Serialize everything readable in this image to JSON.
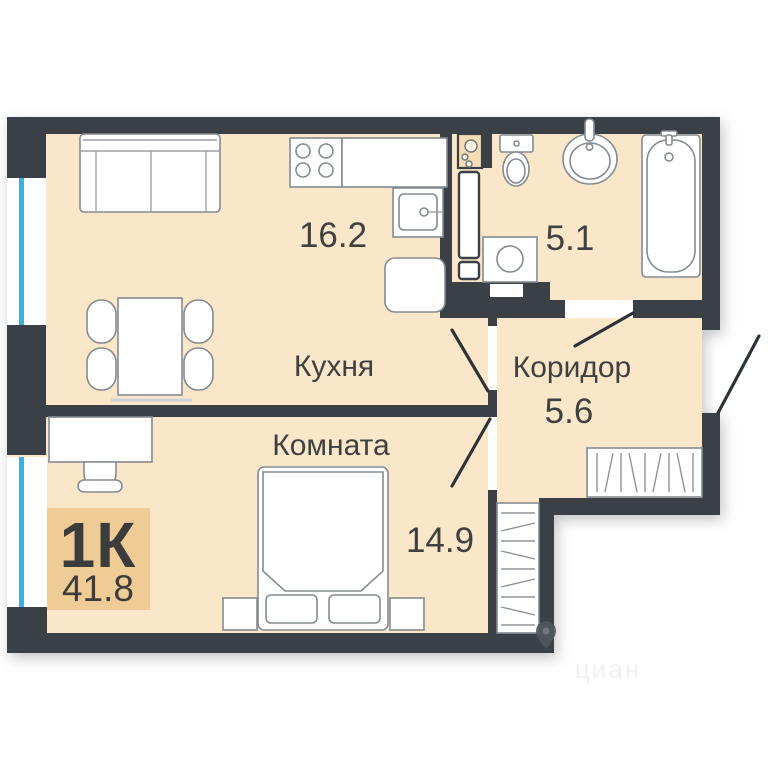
{
  "plan": {
    "badge": {
      "label": "1К",
      "area": "41.8"
    },
    "rooms": {
      "kitchen": {
        "name": "Кухня",
        "area": "16.2"
      },
      "bedroom": {
        "name": "Комната",
        "area": "14.9"
      },
      "corridor": {
        "name": "Коридор",
        "area": "5.6"
      },
      "bathroom": {
        "area": "5.1"
      }
    },
    "watermark": {
      "text": "циан"
    },
    "colors": {
      "wall": "#3B4046",
      "floor": "#FAE7C9",
      "badge_bg": "#EFCB96",
      "label_text": "#3F4040",
      "window_glass": "#3FAEDC",
      "furniture_stroke": "#848B91"
    },
    "furniture_icons": [
      "sofa",
      "dining-table",
      "chair",
      "stove",
      "kitchen-counter",
      "kitchen-sink",
      "fridge",
      "utility-shaft",
      "washing-machine",
      "toilet",
      "bathroom-sink",
      "bathtub",
      "bed",
      "pillow",
      "nightstand",
      "desk",
      "desk-chair",
      "wardrobe"
    ]
  }
}
